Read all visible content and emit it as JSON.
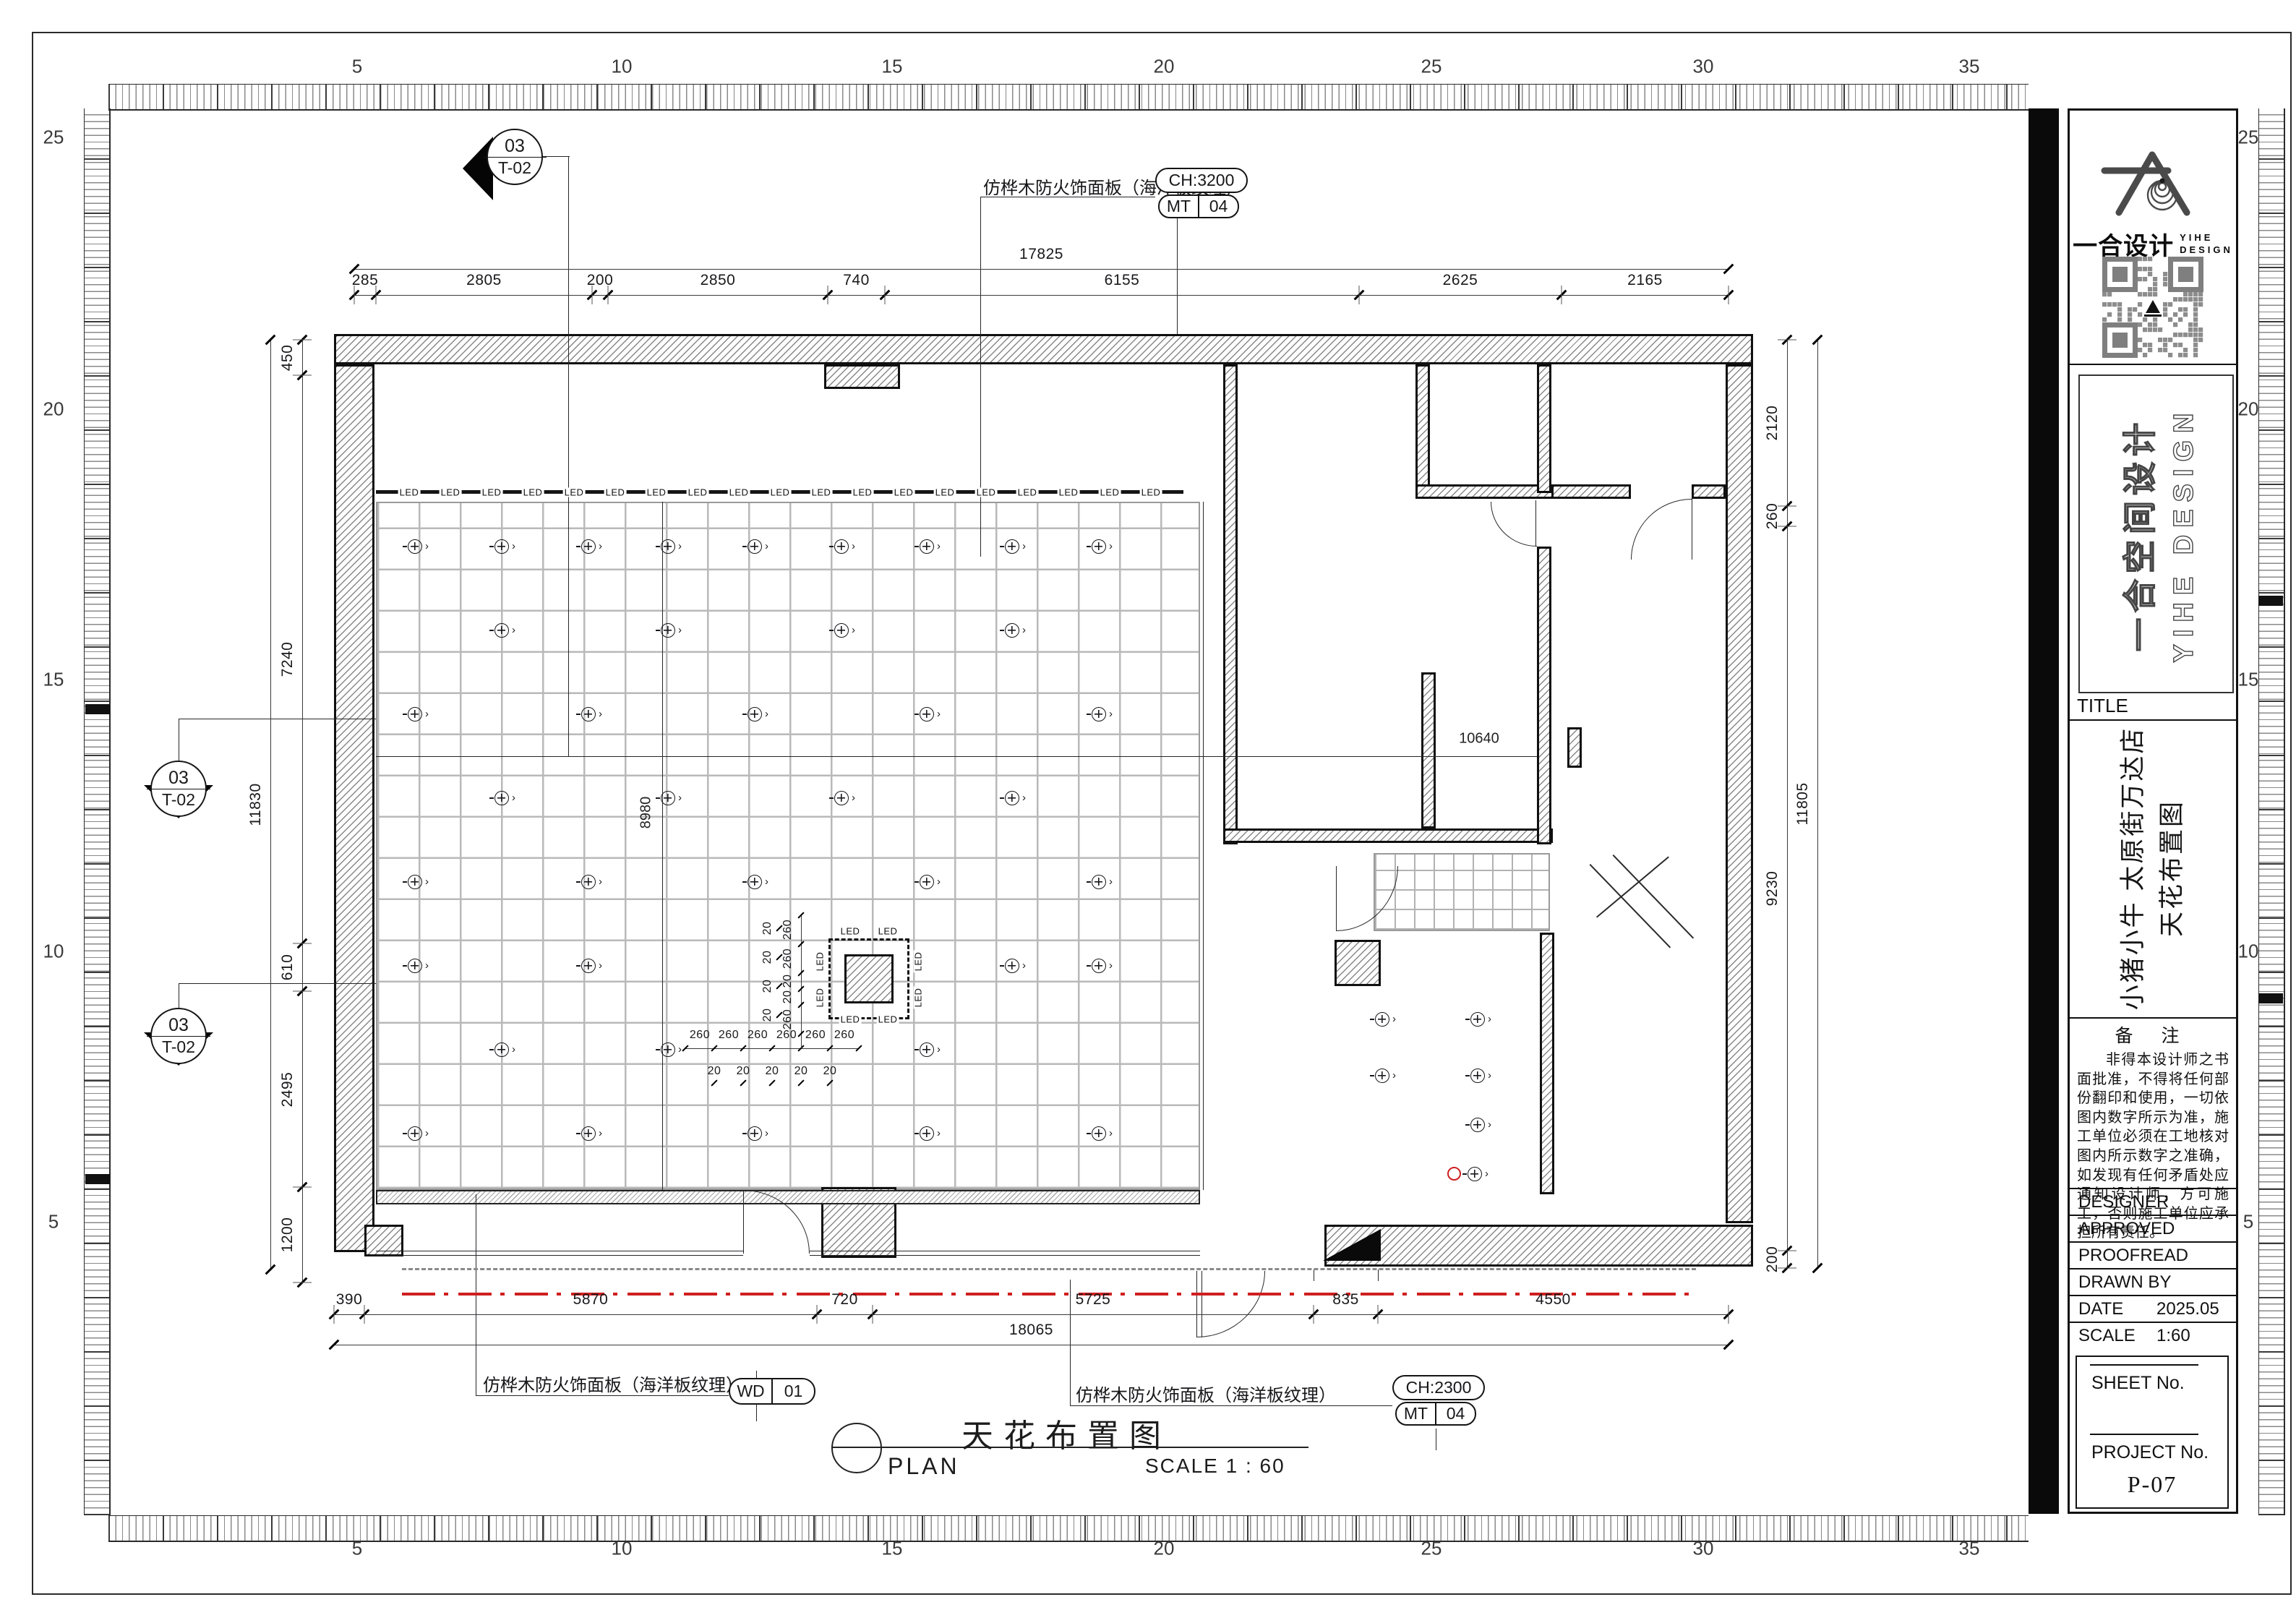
{
  "rulers": {
    "top": [
      "5",
      "10",
      "15",
      "20",
      "25",
      "30",
      "35"
    ],
    "bottom": [
      "5",
      "10",
      "15",
      "20",
      "25",
      "30",
      "35"
    ],
    "left": [
      "25",
      "20",
      "15",
      "10",
      "5"
    ],
    "right": [
      "25",
      "20",
      "15",
      "10",
      "5"
    ]
  },
  "titleblock": {
    "brand_cn_inline": "一合设计",
    "brand_en_l1": "YIHE",
    "brand_en_l2": "DESIGN",
    "brand_vert_cn": "一合空间设计",
    "brand_vert_en": "YIHE DESIGN",
    "title_label": "TITLE",
    "project_l1": "小猪小牛 太原街万达店",
    "project_l2": "天花布置图",
    "notes_title": "备 注",
    "notes_body": "非得本设计师之书面批准，不得将任何部份翻印和使用，一切依图内数字所示为准，施工单位必须在工地核对图内所示数字之准确，如发现有任何矛盾处应通知设计师，方可施工，否则施工单位应承担所有责任。",
    "rows": [
      {
        "label": "DESIGNER",
        "value": ""
      },
      {
        "label": "APPROVED",
        "value": ""
      },
      {
        "label": "PROOFREAD",
        "value": ""
      },
      {
        "label": "DRAWN BY",
        "value": ""
      },
      {
        "label": "DATE",
        "value": "2025.05"
      },
      {
        "label": "SCALE",
        "value": "1:60"
      }
    ],
    "sheet_no_label": "SHEET No.",
    "project_no_label": "PROJECT No.",
    "project_no": "P-07"
  },
  "plan_title": {
    "cn": "天花布置图",
    "en": "PLAN",
    "scale": "SCALE 1 : 60"
  },
  "annotations": {
    "top": {
      "text": "仿桦木防火饰面板（海洋板纹理）",
      "tag1": "CH:3200",
      "tag2l": "MT",
      "tag2r": "04"
    },
    "bl": {
      "text": "仿桦木防火饰面板（海洋板纹理）",
      "tagl": "WD",
      "tagr": "01"
    },
    "br": {
      "text": "仿桦木防火饰面板（海洋板纹理）",
      "tag1": "CH:2300",
      "tag2l": "MT",
      "tag2r": "04"
    }
  },
  "markers": {
    "num": "03",
    "ref": "T-02"
  },
  "led_label": "LED",
  "dims": {
    "top_overall": "17825",
    "top": [
      "285",
      "2805",
      "200",
      "2850",
      "740",
      "6155",
      "2625",
      "2165"
    ],
    "left_overall": "11830",
    "left": [
      "450",
      "7240",
      "610",
      "2495",
      "1200"
    ],
    "right_overall": "11805",
    "right": [
      "2120",
      "260",
      "9230",
      "200"
    ],
    "bottom_overall": "18065",
    "bottom": [
      "390",
      "5870",
      "720",
      "5725",
      "835",
      "4550"
    ],
    "inner_h": "10640",
    "inner_v": "8980",
    "chain": "260",
    "chain_small": "20"
  }
}
